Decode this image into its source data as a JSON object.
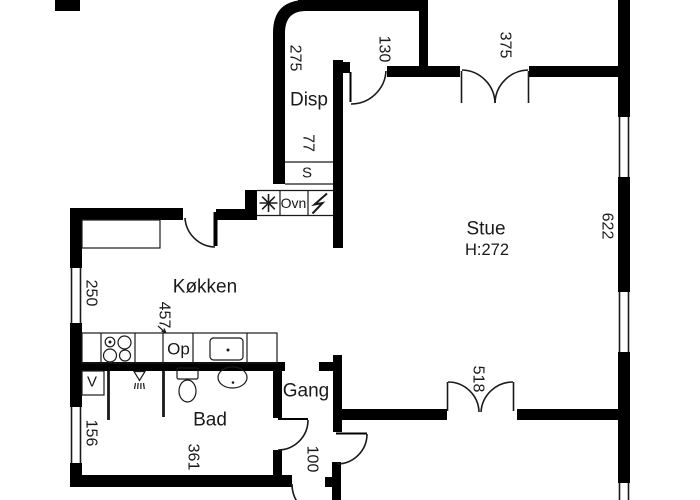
{
  "plan_title": "Apartment floor plan",
  "rooms": {
    "disp": "Disp",
    "stue": "Stue",
    "stue_ceiling_height": "H:272",
    "koekken": "Køkken",
    "gang": "Gang",
    "bad": "Bad"
  },
  "closets": {
    "s": "S",
    "v": "V"
  },
  "appliances": {
    "ovn": "Ovn",
    "op": "Op"
  },
  "symbols": {
    "stove": "stove-asterisk-icon",
    "power": "lightning-icon",
    "shower": "shower-icon"
  },
  "dimensions": {
    "d275": "275",
    "d130": "130",
    "d375": "375",
    "d77": "77",
    "d622": "622",
    "d250": "250",
    "d457": "457",
    "d518": "518",
    "d156": "156",
    "d361": "361",
    "d100": "100"
  },
  "colors": {
    "wall": "#000000",
    "line": "#1a1a1a",
    "background": "#ffffff",
    "text": "#1a1a1a"
  }
}
